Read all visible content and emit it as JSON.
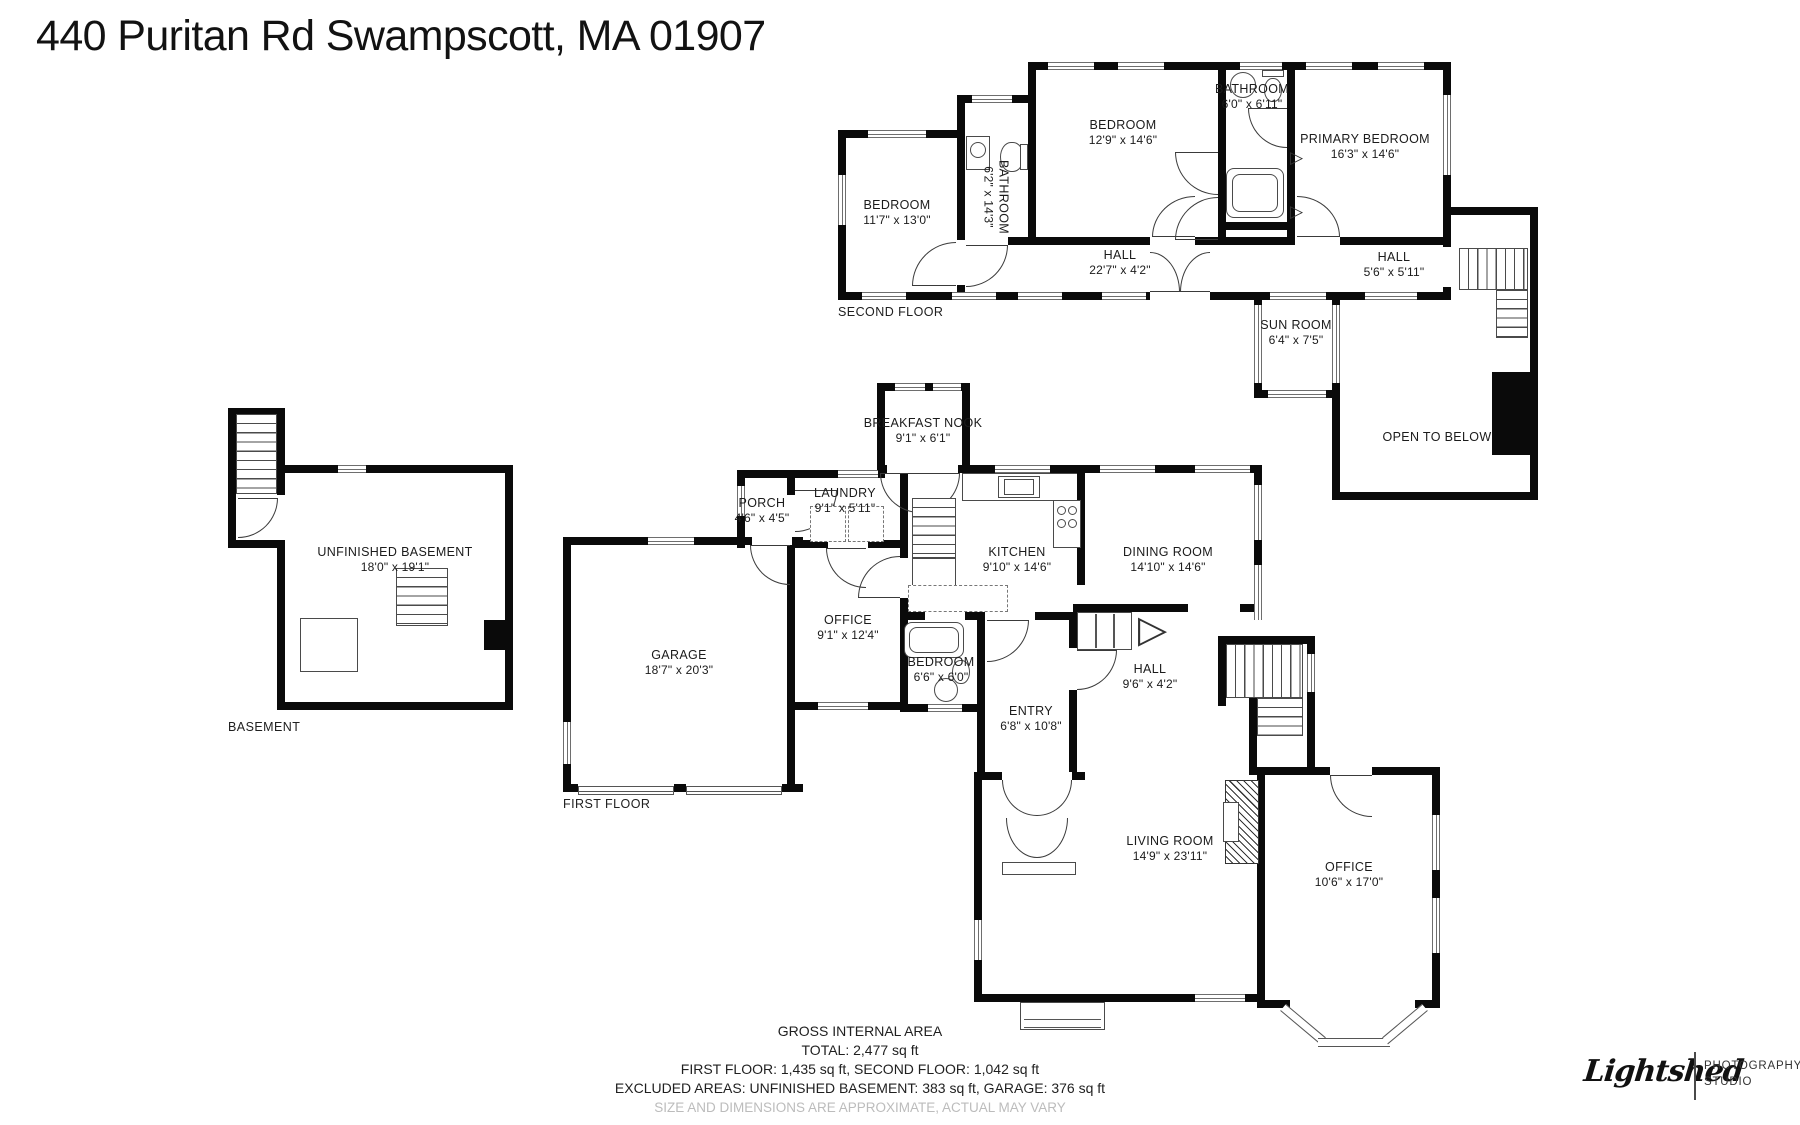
{
  "page_title": "440 Puritan Rd Swampscott, MA 01907",
  "floors": {
    "second": {
      "label": "SECOND FLOOR",
      "rooms": {
        "bedroom_left": {
          "name": "BEDROOM",
          "dims": "11'7\" x 13'0\""
        },
        "bathroom_vertical": {
          "name": "BATHROOM",
          "dims": "6'2\" x 14'3\""
        },
        "bedroom_middle": {
          "name": "BEDROOM",
          "dims": "12'9\" x 14'6\""
        },
        "bathroom_top": {
          "name": "BATHROOM",
          "dims": "6'0\" x 6'11\""
        },
        "primary_bedroom": {
          "name": "PRIMARY BEDROOM",
          "dims": "16'3\" x 14'6\""
        },
        "hall_long": {
          "name": "HALL",
          "dims": "22'7\" x 4'2\""
        },
        "hall_small": {
          "name": "HALL",
          "dims": "5'6\" x 5'11\""
        },
        "sun_room": {
          "name": "SUN ROOM",
          "dims": "6'4\" x 7'5\""
        },
        "open_to_below": {
          "name": "OPEN TO BELOW"
        }
      }
    },
    "basement": {
      "label": "BASEMENT",
      "rooms": {
        "unfinished_basement": {
          "name": "UNFINISHED BASEMENT",
          "dims": "18'0\" x 19'1\""
        }
      }
    },
    "first": {
      "label": "FIRST FLOOR",
      "rooms": {
        "breakfast_nook": {
          "name": "BREAKFAST NOOK",
          "dims": "9'1\" x 6'1\""
        },
        "porch": {
          "name": "PORCH",
          "dims": "4'6\" x 4'5\""
        },
        "laundry": {
          "name": "LAUNDRY",
          "dims": "9'1\" x 5'11\""
        },
        "kitchen": {
          "name": "KITCHEN",
          "dims": "9'10\" x 14'6\""
        },
        "dining_room": {
          "name": "DINING ROOM",
          "dims": "14'10\" x 14'6\""
        },
        "office_small": {
          "name": "OFFICE",
          "dims": "9'1\" x 12'4\""
        },
        "garage": {
          "name": "GARAGE",
          "dims": "18'7\" x 20'3\""
        },
        "bedroom_small": {
          "name": "BEDROOM",
          "dims": "6'6\" x 6'0\""
        },
        "entry": {
          "name": "ENTRY",
          "dims": "6'8\" x 10'8\""
        },
        "hall": {
          "name": "HALL",
          "dims": "9'6\" x 4'2\""
        },
        "living_room": {
          "name": "LIVING ROOM",
          "dims": "14'9\" x 23'11\""
        },
        "office_large": {
          "name": "OFFICE",
          "dims": "10'6\" x 17'0\""
        }
      }
    }
  },
  "footer": {
    "title": "GROSS INTERNAL AREA",
    "total": "TOTAL: 2,477 sq ft",
    "floors_line": "FIRST FLOOR: 1,435 sq ft, SECOND FLOOR: 1,042 sq ft",
    "excluded_line": "EXCLUDED AREAS: UNFINISHED BASEMENT: 383 sq ft, GARAGE: 376 sq ft",
    "disclaimer": "SIZE AND DIMENSIONS ARE APPROXIMATE, ACTUAL MAY VARY"
  },
  "logo": {
    "brand": "Lightshed",
    "tagline1": "PHOTOGRAPHY",
    "tagline2": "STUDIO"
  },
  "colors": {
    "wall": "#0a0a0a",
    "text": "#1b1b1b",
    "muted": "#bcbcbc"
  }
}
